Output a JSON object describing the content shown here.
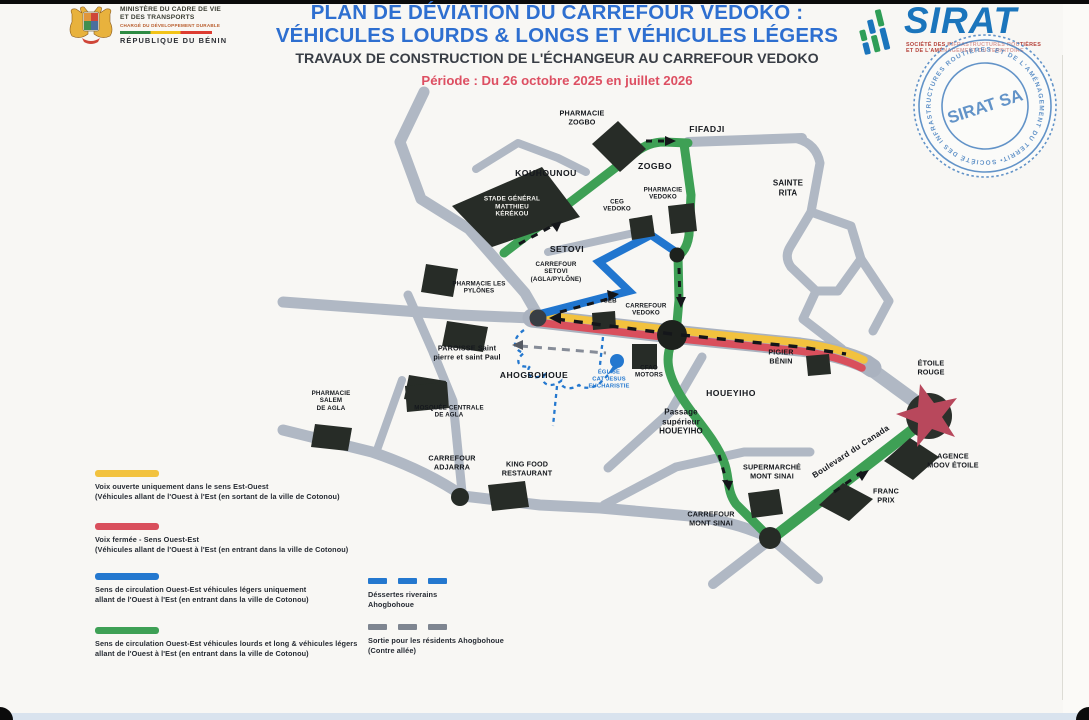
{
  "header": {
    "ministry": {
      "line1": "MINISTÈRE DU CADRE DE VIE",
      "line2": "ET DES TRANSPORTS",
      "line3": "CHARGÉ DU DÉVELOPPEMENT DURABLE",
      "line4": "RÉPUBLIQUE DU BÉNIN"
    },
    "title_line1": "PLAN DE DÉVIATION DU CARREFOUR VEDOKO :",
    "title_line2": "VÉHICULES LOURDS & LONGS ET VÉHICULES LÉGERS",
    "subtitle": "TRAVAUX DE CONSTRUCTION DE L'ÉCHANGEUR AU CARREFOUR VEDOKO",
    "period": "Période : Du 26 octobre 2025 en juillet 2026",
    "sirat": {
      "name": "SIRAT",
      "subtitle_line1": "SOCIÉTÉ DES INFRASTRUCTURES ROUTIÈRES",
      "subtitle_line2": "ET DE L'AMÉNAGEMENT DU TERRITOIRE"
    },
    "stamp": {
      "ring": "• SOCIÉTÉ DES INFRASTRUCTURES ROUTIÈRES ET DE L'AMÉNAGEMENT DU TERRITOIRE •",
      "center": "SIRAT SA"
    }
  },
  "map": {
    "labels": [
      {
        "text": "PHARMACIE\nZOGBO"
      },
      {
        "text": "FIFADJI"
      },
      {
        "text": "KOUHOUNOU"
      },
      {
        "text": "ZOGBO"
      },
      {
        "text": "SAINTE\nRITA"
      },
      {
        "text": "STADE GÉNÉRAL\nMATTHIEU\nKÉRÉKOU"
      },
      {
        "text": "CEG\nVEDOKO"
      },
      {
        "text": "PHARMACIE\nVEDOKO"
      },
      {
        "text": "SETOVI"
      },
      {
        "text": "CARREFOUR\nSETOVI\n(AGLA/PYLÔNE)"
      },
      {
        "text": "PHARMACIE LES\nPYLÔNES"
      },
      {
        "text": "CEB"
      },
      {
        "text": "CARREFOUR\nVEDOKO"
      },
      {
        "text": "PIGIER\nBÉNIN"
      },
      {
        "text": "PAROISSE Saint\npierre et saint Paul"
      },
      {
        "text": "AHOGBOHOUE"
      },
      {
        "text": "ÉGLISE\nCAT JESUS\nEUCHARISTIE"
      },
      {
        "text": "CFAO\nMOTORS"
      },
      {
        "text": "HOUEYIHO"
      },
      {
        "text": "Passage\nsupérieur\nHOUEYIHO"
      },
      {
        "text": "PHARMACIE\nSALEM\nDE AGLA"
      },
      {
        "text": "MOSQUÉE CENTRALE\nDE AGLA"
      },
      {
        "text": "CARREFOUR\nADJARRA"
      },
      {
        "text": "KING FOOD\nRESTAURANT"
      },
      {
        "text": "SUPERMARCHÉ\nMONT SINAI"
      },
      {
        "text": "CARREFOUR\nMONT SINAI"
      },
      {
        "text": "Boulevard du Canada"
      },
      {
        "text": "FRANC\nPRIX"
      },
      {
        "text": "AGENCE\nMOOV ÉTOILE"
      },
      {
        "text": "ÉTOILE\nROUGE"
      }
    ]
  },
  "legend": {
    "items": [
      {
        "color": "#f2c23e",
        "text": "Voix ouverte uniquement dans le sens Est-Ouest\n(Véhicules allant de l'Ouest à l'Est (en sortant de la ville de Cotonou)"
      },
      {
        "color": "#d94f5c",
        "text": "Voix fermée - Sens  Ouest-Est\n(Véhicules allant de l'Ouest à l'Est (en entrant dans la ville de Cotonou)"
      },
      {
        "color": "#2478cf",
        "text": "Sens de circulation  Ouest-Est véhicules légers uniquement\nallant de l'Ouest à l'Est (en entrant dans la ville de Cotonou)"
      },
      {
        "color": "#3ea055",
        "text": "Sens de circulation  Ouest-Est véhicules lourds et long & véhicules légers\nallant de l'Ouest à l'Est (en entrant dans la ville de Cotonou)"
      }
    ],
    "dashed_items": [
      {
        "color": "#2478cf",
        "text": "Déssertes riverains\nAhogbohoue"
      },
      {
        "color": "#7e8590",
        "text": "Sortie pour les résidents Ahogbohoue\n(Contre allée)"
      }
    ]
  },
  "colors": {
    "route_open_eastwest": "#f2c23e",
    "route_closed": "#d94f5c",
    "route_light_vehicles": "#2478cf",
    "route_heavy_vehicles": "#3ea055",
    "road_gray": "#b0b8c4",
    "title_blue": "#2e6fd0",
    "period_red": "#dd4f62",
    "stamp_blue": "#4e86c2"
  }
}
